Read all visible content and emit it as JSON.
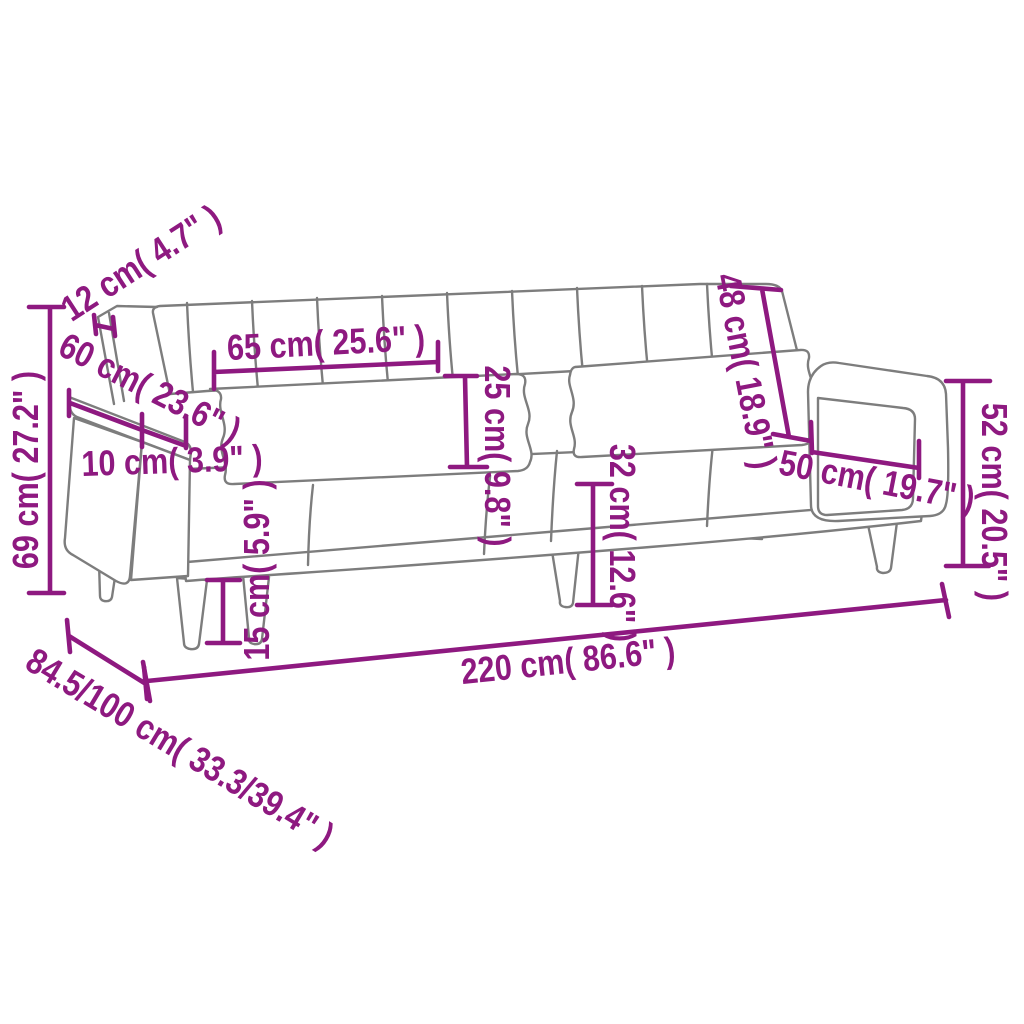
{
  "colors": {
    "accent": "#8E1980",
    "outline": "#7D7D7D",
    "background": "#FFFFFF"
  },
  "measurements": {
    "dim_12": "12 cm( 4.7\" )",
    "dim_60": "60 cm( 23.6\" )",
    "dim_69": "69 cm( 27.2\" )",
    "dim_10": "10 cm( 3.9\" )",
    "dim_65": "65 cm( 25.6\" )",
    "dim_25": "25 cm( 9.8\" )",
    "dim_48": "48 cm( 18.9\" )",
    "dim_32": "32 cm( 12.6\" )",
    "dim_50": "50 cm( 19.7\" )",
    "dim_52": "52 cm( 20.5\" )",
    "dim_15": "15 cm( 5.9\" )",
    "dim_220": "220 cm( 86.6\" )",
    "dim_depth": "84.5/100 cm( 33.3/39.4\" )"
  }
}
